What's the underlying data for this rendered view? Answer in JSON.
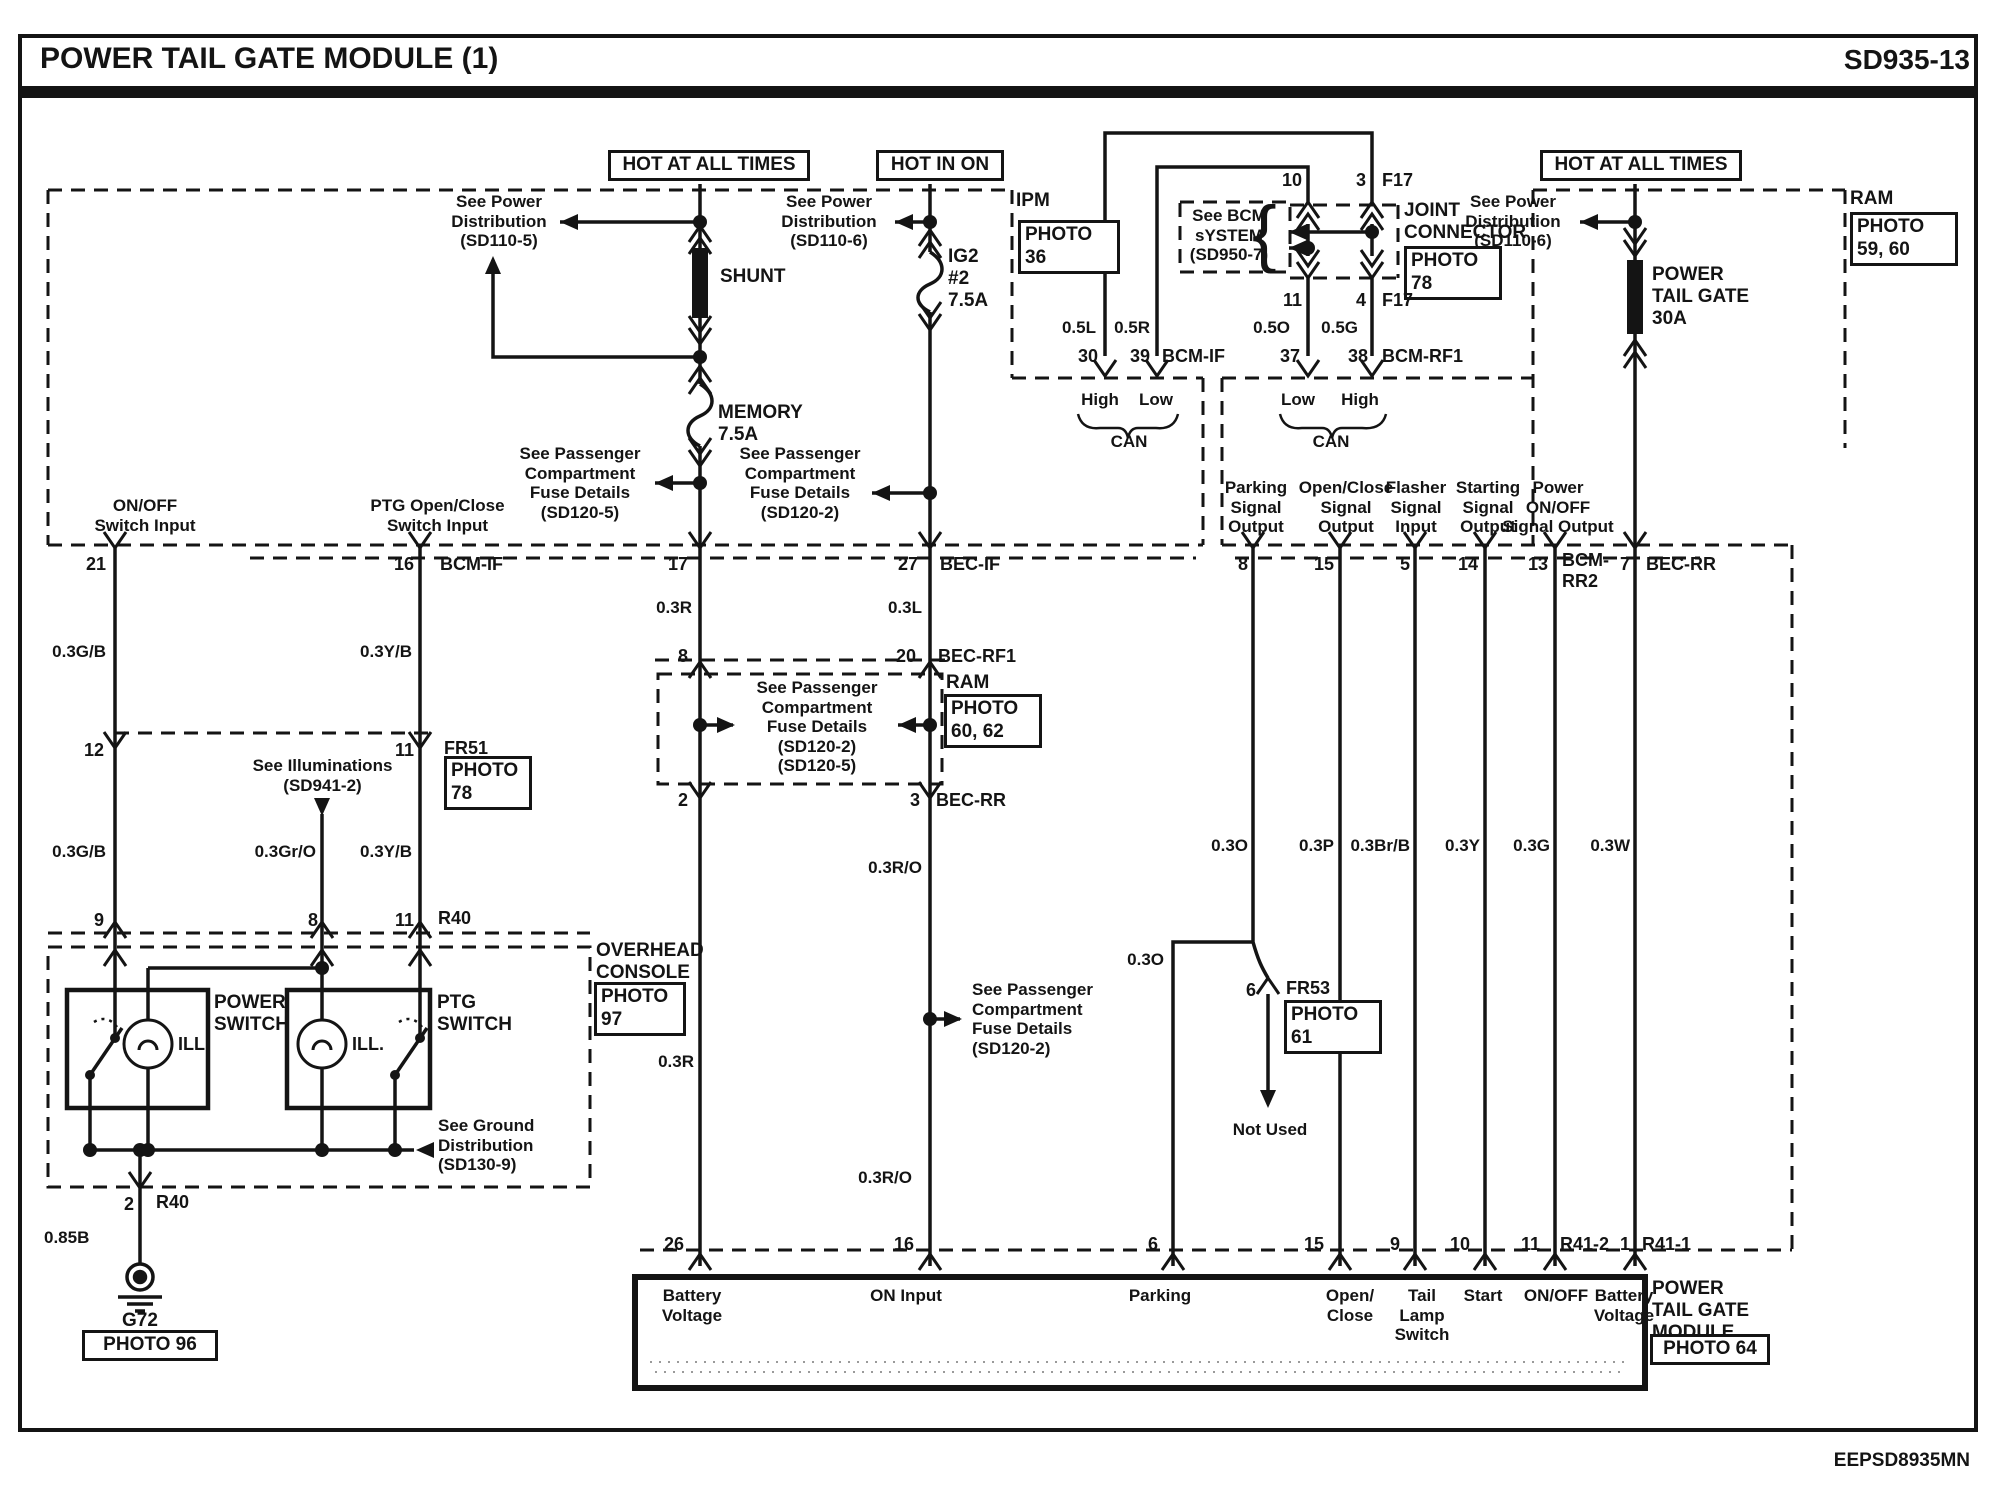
{
  "colors": {
    "ink": "#141414",
    "paper": "#ffffff"
  },
  "labels": {
    "title": "POWER TAIL GATE MODULE (1)",
    "code": "SD935-13",
    "footer": "EEPSD8935MN",
    "hot_left": "HOT AT ALL TIMES",
    "hot_mid": "HOT IN ON",
    "hot_right": "HOT AT ALL TIMES",
    "n_sd110_5": "See Power\nDistribution\n(SD110-5)",
    "n_sd110_6m": "See Power\nDistribution\n(SD110-6)",
    "n_sd110_6r": "See Power\nDistribution\n(SD110-6)",
    "n_ipm": "IPM",
    "ph36": "PHOTO\n36",
    "n_see_bcm": "See BCM\nsYSTEM\n(SD950-7)",
    "brace": "{",
    "jc_label": "JOINT\nCONNECTOR",
    "ph78a": "PHOTO\n78",
    "ph78b": "PHOTO\n78",
    "ram_r": "RAM",
    "ram_m": "RAM",
    "ph59": "PHOTO\n59, 60",
    "ph62": "PHOTO\n60, 62",
    "ptg30a": "POWER\nTAIL GATE\n30A",
    "shunt": "SHUNT",
    "memory": "MEMORY\n7.5A",
    "ig2": "IG2\n#2\n7.5A",
    "w_05l": "0.5L",
    "w_05r": "0.5R",
    "w_05o": "0.5O",
    "w_05g": "0.5G",
    "p10": "10",
    "p3": "3",
    "f17a": "F17",
    "p11c": "11",
    "p4": "4",
    "f17b": "F17",
    "p30": "30",
    "p39": "39",
    "bcm_if1": "BCM-IF",
    "bcm_if2": "BCM-IF",
    "p37": "37",
    "p38": "38",
    "bcm_rf1": "BCM-RF1",
    "can1_high": "High",
    "can1_low": "Low",
    "can1": "CAN",
    "can2_low": "Low",
    "can2_high": "High",
    "can2": "CAN",
    "n_sd120_5l": "See Passenger\nCompartment\nFuse Details\n(SD120-5)",
    "n_sd120_2m": "See Passenger\nCompartment\nFuse Details\n(SD120-2)",
    "onoff_in": "ON/OFF\nSwitch Input",
    "ptg_in": "PTG Open/Close\nSwitch Input",
    "sig_parking": "Parking\nSignal\nOutput",
    "sig_oc": "Open/Close\nSignal\nOutput",
    "sig_fl": "Flasher\nSignal\nInput",
    "sig_st": "Starting\nSignal\nOutput",
    "sig_pw": "Power\nON/OFF\nSignal Output",
    "p21": "21",
    "p16": "16",
    "p17": "17",
    "p27": "27",
    "bec_if": "BEC-IF",
    "p8s": "8",
    "p15s": "15",
    "p5s": "5",
    "p14s": "14",
    "p13s": "13",
    "bcm_rr2": "BCM-\nRR2",
    "p7s": "7",
    "bec_rr2": "BEC-RR",
    "w_03r1": "0.3R",
    "w_03r2": "0.3R",
    "w_03l": "0.3L",
    "p8f": "8",
    "p20": "20",
    "bec_rf1b": "BEC-RF1",
    "n_fusebox": "See Passenger\nCompartment\nFuse Details\n(SD120-2)\n(SD120-5)",
    "p2f": "2",
    "p3f": "3",
    "bec_rr1": "BEC-RR",
    "p12": "12",
    "p11a": "11",
    "fr51": "FR51",
    "n_illum": "See Illuminations\n(SD941-2)",
    "w_03gb1": "0.3G/B",
    "w_03gb2": "0.3G/B",
    "w_03yb1": "0.3Y/B",
    "w_03yb2": "0.3Y/B",
    "w_03gro": "0.3Gr/O",
    "p9": "9",
    "p8c": "8",
    "p11b": "11",
    "r40a": "R40",
    "r40b": "R40",
    "overhead": "OVERHEAD\nCONSOLE",
    "ph97": "PHOTO\n97",
    "pwr_sw": "POWER\nSWITCH",
    "ptg_sw": "PTG\nSWITCH",
    "ill1": "ILL.",
    "ill2": "ILL.",
    "n_ground": "See Ground\nDistribution\n(SD130-9)",
    "p2r": "2",
    "w_085b": "0.85B",
    "g72": "G72",
    "ph96": "PHOTO 96",
    "w_03ro1": "0.3R/O",
    "w_03ro2": "0.3R/O",
    "n_sd120_2low": "See Passenger\nCompartment\nFuse Details\n(SD120-2)",
    "w_03o1": "0.3O",
    "w_03o2": "0.3O",
    "p6f": "6",
    "fr53": "FR53",
    "ph61": "PHOTO\n61",
    "n_notused": "Not Used",
    "w_03p": "0.3P",
    "w_03brb": "0.3Br/B",
    "w_03y": "0.3Y",
    "w_03g": "0.3G",
    "w_03w": "0.3W",
    "p26": "26",
    "p16b": "16",
    "p6b": "6",
    "p15b": "15",
    "p9b": "9",
    "p10b": "10",
    "p11d": "11",
    "r41_2": "R41-2",
    "p1b": "1",
    "r41_1": "R41-1",
    "m_batt1": "Battery\nVoltage",
    "m_on": "ON Input",
    "m_parking": "Parking",
    "m_oc": "Open/\nClose",
    "m_tls": "Tail\nLamp\nSwitch",
    "m_start": "Start",
    "m_onoff": "ON/OFF",
    "m_batt2": "Battery\nVoltage",
    "ptgm": "POWER\nTAIL GATE\nMODULE",
    "ph64": "PHOTO 64"
  }
}
